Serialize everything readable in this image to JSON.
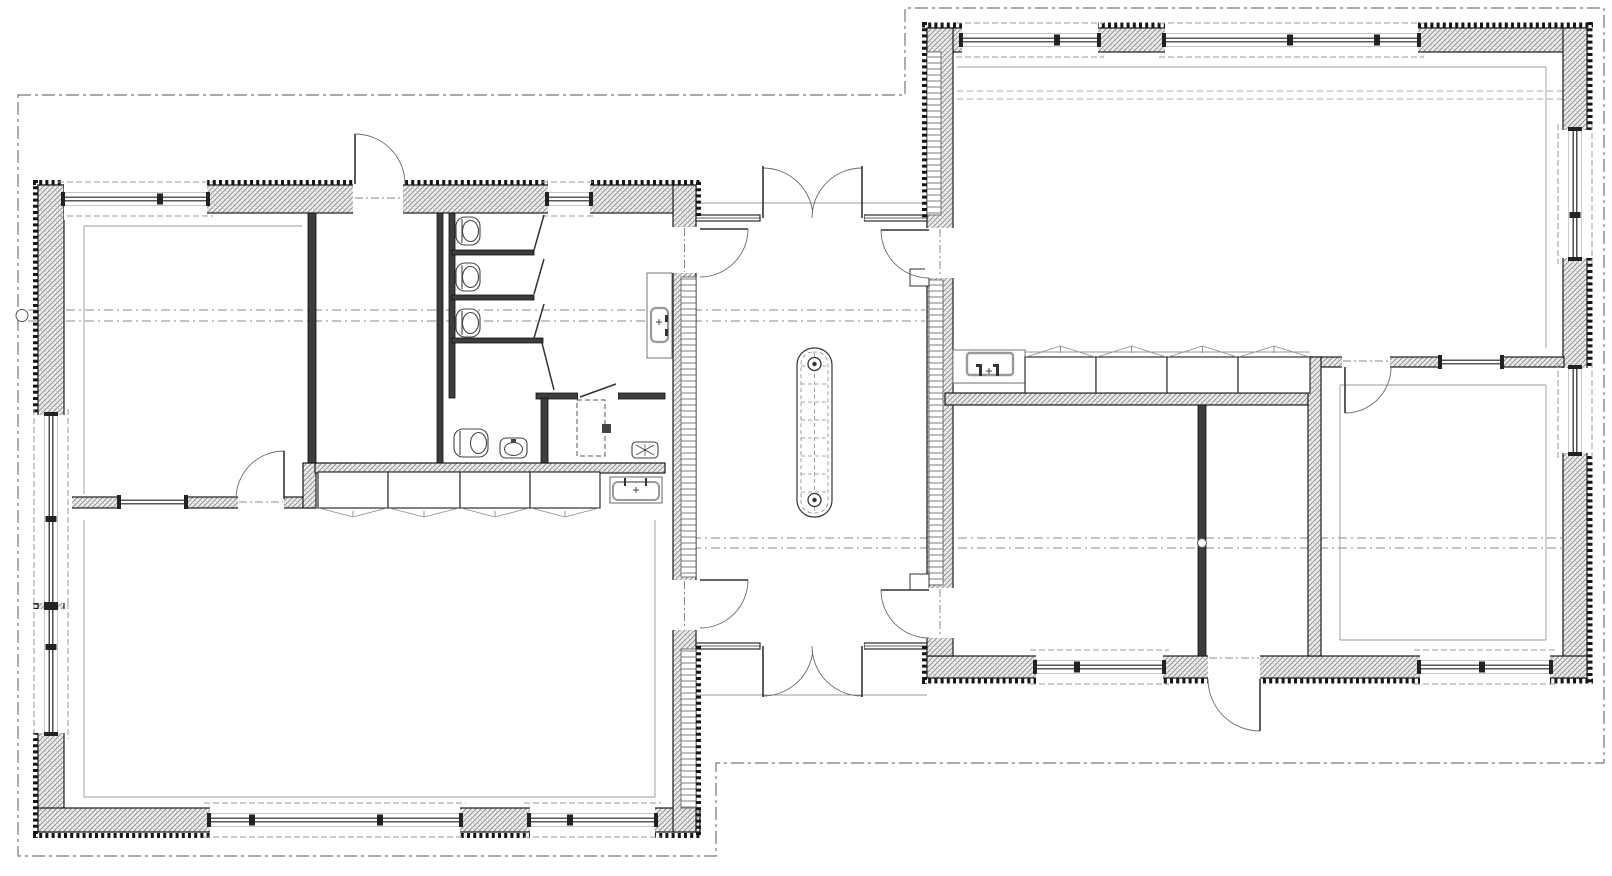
{
  "meta": {
    "canvas": {
      "w": 1612,
      "h": 876
    },
    "colors": {
      "paper": "#ffffff",
      "wall_line": "#1c1c1c",
      "wall_fill": "#f0f0ee",
      "partition_fill": "#3d3d3d",
      "teeth": "#161616",
      "arc": "#6a6a6a",
      "dash": "#8a8a8a",
      "thin": "#9a9a9a",
      "fixture": "#444444",
      "basin_stroke": "#999999"
    }
  },
  "plan": {
    "roof_overhang_outline": [
      [
        18,
        95
      ],
      [
        905,
        95
      ],
      [
        905,
        8
      ],
      [
        1604,
        8
      ],
      [
        1604,
        763
      ],
      [
        716,
        763
      ],
      [
        716,
        856
      ],
      [
        18,
        856
      ]
    ],
    "ridge_dash_lines": [
      [
        28,
        310,
        925,
        310
      ],
      [
        28,
        321,
        925,
        321
      ],
      [
        673,
        538,
        1563,
        538
      ],
      [
        673,
        548,
        1563,
        548
      ]
    ],
    "interior_dash_lines": [
      [
        957,
        91,
        1563,
        91
      ],
      [
        957,
        99,
        1563,
        99
      ]
    ],
    "marker_circles": [
      [
        22,
        315.5,
        6
      ],
      [
        1202,
        543,
        4.5
      ]
    ],
    "hatch_walls": [
      [
        38,
        185,
        658,
        28
      ],
      [
        38,
        185,
        26,
        647
      ],
      [
        38,
        808,
        662,
        24
      ],
      [
        673,
        185,
        23,
        647
      ],
      [
        927,
        28,
        660,
        24
      ],
      [
        1563,
        28,
        24,
        650
      ],
      [
        927,
        656,
        660,
        22
      ],
      [
        927,
        28,
        26,
        628
      ],
      [
        56,
        497,
        259,
        11
      ],
      [
        303,
        463,
        13,
        45
      ],
      [
        315,
        463,
        350,
        10
      ],
      [
        945,
        393,
        375,
        12
      ],
      [
        1308,
        357,
        256,
        10
      ],
      [
        1308,
        357,
        13,
        299
      ]
    ],
    "solid_walls": [
      [
        308,
        213,
        8,
        250
      ],
      [
        437,
        213,
        6,
        250
      ],
      [
        449,
        213,
        6,
        185
      ],
      [
        452,
        250,
        82,
        5
      ],
      [
        452,
        295,
        82,
        5
      ],
      [
        452,
        338,
        91,
        5
      ],
      [
        536,
        393,
        42,
        6
      ],
      [
        618,
        393,
        47,
        6
      ],
      [
        541,
        398,
        7,
        65
      ],
      [
        1198,
        405,
        8,
        251
      ]
    ],
    "ladder_strips": [
      [
        681,
        277,
        15,
        300
      ],
      [
        681,
        649,
        15,
        159
      ],
      [
        927,
        52,
        14,
        163
      ],
      [
        929,
        280,
        14,
        305
      ]
    ],
    "teeth_lines": [
      [
        33,
        182.5,
        701,
        182.5
      ],
      [
        35.5,
        180,
        35.5,
        838
      ],
      [
        33,
        835.5,
        701,
        835.5
      ],
      [
        698.5,
        182,
        698.5,
        218
      ],
      [
        698.5,
        646,
        698.5,
        835
      ],
      [
        924.5,
        22,
        924.5,
        218
      ],
      [
        924.5,
        646,
        924.5,
        684
      ],
      [
        922,
        25,
        1593,
        25
      ],
      [
        1590,
        22,
        1590,
        684
      ],
      [
        922,
        681,
        1593,
        681
      ]
    ],
    "glazed_walls": [
      [
        696,
        215,
        64,
        6
      ],
      [
        864,
        215,
        63,
        6
      ],
      [
        696,
        643,
        64,
        6
      ],
      [
        864,
        643,
        63,
        6
      ]
    ],
    "thin_lines": [
      [
        696,
        203,
        927,
        203
      ],
      [
        696,
        695,
        927,
        695
      ],
      [
        84,
        226,
        302,
        226
      ],
      [
        84,
        226,
        84,
        494
      ],
      [
        84,
        520,
        84,
        797
      ],
      [
        84,
        797,
        655,
        797
      ],
      [
        655,
        520,
        655,
        797
      ],
      [
        957,
        67,
        1546,
        67
      ],
      [
        1546,
        67,
        1546,
        348
      ],
      [
        1340,
        385,
        1546,
        385
      ],
      [
        1546,
        385,
        1546,
        640
      ],
      [
        1340,
        640,
        1546,
        640
      ],
      [
        1340,
        385,
        1340,
        640
      ],
      [
        1025,
        352,
        1310,
        352
      ],
      [
        953,
        379,
        1025,
        379
      ],
      [
        953,
        383,
        1025,
        383
      ]
    ],
    "windows": [
      {
        "o": "h",
        "a": 64,
        "b": 207,
        "c": 199,
        "m": [
          160
        ]
      },
      {
        "o": "h",
        "a": 548,
        "b": 590,
        "c": 199,
        "m": []
      },
      {
        "o": "v",
        "a": 415,
        "b": 603,
        "c": 51,
        "m": [
          519
        ]
      },
      {
        "o": "v",
        "a": 609,
        "b": 733,
        "c": 51,
        "m": [
          647
        ]
      },
      {
        "o": "h",
        "a": 210,
        "b": 460,
        "c": 820,
        "m": [
          252,
          380
        ]
      },
      {
        "o": "h",
        "a": 530,
        "b": 655,
        "c": 820,
        "m": [
          570
        ]
      },
      {
        "o": "h",
        "a": 962,
        "b": 1098,
        "c": 40,
        "m": [
          1057
        ]
      },
      {
        "o": "h",
        "a": 1165,
        "b": 1418,
        "c": 40,
        "m": [
          1290,
          1377
        ]
      },
      {
        "o": "v",
        "a": 130,
        "b": 258,
        "c": 1575,
        "m": [
          215
        ]
      },
      {
        "o": "v",
        "a": 368,
        "b": 453,
        "c": 1575,
        "m": []
      },
      {
        "o": "h",
        "a": 1036,
        "b": 1163,
        "c": 667,
        "m": [
          1077
        ]
      },
      {
        "o": "h",
        "a": 1420,
        "b": 1550,
        "c": 667,
        "m": [
          1482
        ]
      },
      {
        "o": "h",
        "a": 120,
        "b": 185,
        "c": 502,
        "m": [],
        "t": 9
      },
      {
        "o": "h",
        "a": 1441,
        "b": 1501,
        "c": 362,
        "m": [],
        "t": 9
      }
    ],
    "doors": [
      {
        "clear": [
          353,
          177,
          50,
          40
        ],
        "leaf": [
          355,
          184,
          355,
          134
        ],
        "arc": {
          "r": 50,
          "s": [
            355,
            134
          ],
          "e": [
            405,
            184
          ],
          "sw": 1
        },
        "dash": [
          355,
          198,
          403,
          198
        ]
      },
      {
        "clear": [
          670,
          227,
          34,
          46
        ],
        "leaf": [
          700,
          229,
          748,
          229
        ],
        "arc": {
          "r": 48,
          "s": [
            748,
            229
          ],
          "e": [
            700,
            277
          ],
          "sw": 1
        },
        "dash": [
          684.5,
          228,
          684.5,
          272
        ]
      },
      {
        "clear": [
          670,
          580,
          34,
          50
        ],
        "leaf": [
          700,
          580,
          748,
          580
        ],
        "arc": {
          "r": 48,
          "s": [
            748,
            580
          ],
          "e": [
            700,
            628
          ],
          "sw": 1
        },
        "dash": [
          684.5,
          581,
          684.5,
          627
        ]
      },
      {
        "clear": [
          925,
          228,
          30,
          50
        ],
        "leaf": [
          929,
          230,
          881,
          230
        ],
        "arc": {
          "r": 48,
          "s": [
            881,
            230
          ],
          "e": [
            929,
            278
          ],
          "sw": 0
        },
        "dash": [
          940,
          229,
          940,
          277
        ]
      },
      {
        "clear": [
          925,
          588,
          30,
          50
        ],
        "leaf": [
          929,
          590,
          881,
          590
        ],
        "arc": {
          "r": 48,
          "s": [
            881,
            590
          ],
          "e": [
            929,
            638
          ],
          "sw": 0
        },
        "dash": [
          940,
          589,
          940,
          637
        ]
      },
      {
        "clear": [
          761,
          213,
          51,
          10
        ],
        "leaf": [
          763,
          218,
          763,
          166
        ],
        "arc": {
          "r": 50,
          "s": [
            763,
            168
          ],
          "e": [
            813,
            218
          ],
          "sw": 1
        }
      },
      {
        "clear": [
          812,
          213,
          52,
          10
        ],
        "leaf": [
          862,
          218,
          862,
          166
        ],
        "arc": {
          "r": 50,
          "s": [
            862,
            168
          ],
          "e": [
            812,
            218
          ],
          "sw": 0
        }
      },
      {
        "clear": [
          761,
          641,
          51,
          10
        ],
        "leaf": [
          763,
          646,
          763,
          697
        ],
        "arc": {
          "r": 50,
          "s": [
            763,
            696
          ],
          "e": [
            813,
            646
          ],
          "sw": 0
        }
      },
      {
        "clear": [
          812,
          641,
          52,
          10
        ],
        "leaf": [
          862,
          646,
          862,
          697
        ],
        "arc": {
          "r": 50,
          "s": [
            862,
            696
          ],
          "e": [
            812,
            646
          ],
          "sw": 1
        }
      },
      {
        "clear": [
          238,
          494,
          46,
          16
        ],
        "leaf": [
          284,
          499,
          284,
          451
        ],
        "arc": {
          "r": 48,
          "s": [
            284,
            451
          ],
          "e": [
            236,
            499
          ],
          "sw": 0
        },
        "dash": [
          239,
          502,
          283,
          502
        ]
      },
      {
        "clear": [
          578,
          391,
          40,
          9
        ],
        "leaf": [
          580,
          397,
          616,
          384
        ]
      },
      {
        "clear": [
          1342,
          354,
          48,
          15
        ],
        "leaf": [
          1345,
          367,
          1345,
          413
        ],
        "arc": {
          "r": 46,
          "s": [
            1391,
            367
          ],
          "e": [
            1345,
            413
          ],
          "sw": 1
        },
        "dash": [
          1343,
          361,
          1389,
          361
        ]
      },
      {
        "clear": [
          1208,
          652,
          52,
          33
        ],
        "leaf": [
          1260,
          679,
          1260,
          731
        ],
        "arc": {
          "r": 52,
          "s": [
            1208,
            679
          ],
          "e": [
            1260,
            731
          ],
          "sw": 0
        },
        "dash": [
          1209,
          658,
          1259,
          658
        ]
      }
    ],
    "stall_door_lines": [
      [
        544,
        215,
        534,
        250
      ],
      [
        544,
        259,
        534,
        294
      ],
      [
        544,
        304,
        534,
        338
      ],
      [
        542,
        343,
        554,
        390
      ]
    ],
    "jamb_steps": [
      [
        910,
        269,
        19,
        17
      ],
      [
        910,
        574,
        19,
        16
      ]
    ],
    "mat": {
      "x": 797,
      "y": 348,
      "w": 35,
      "h": 169,
      "r": 17,
      "grid_step": 18,
      "drains": [
        [
          814.5,
          364
        ],
        [
          814.5,
          500
        ]
      ]
    },
    "fixtures": {
      "wc_toilets": [
        [
          456,
          217
        ],
        [
          456,
          263
        ],
        [
          456,
          309
        ]
      ],
      "bath_toilet": [
        454,
        429
      ],
      "bath_bidet": [
        500,
        438
      ],
      "shower_dashed": [
        577,
        400,
        28,
        56
      ],
      "shower_head": [
        602,
        424,
        9,
        9
      ],
      "shower_tray": [
        632,
        442,
        26,
        16
      ],
      "vanity": [
        610,
        477,
        52,
        26
      ],
      "corridor_basin": {
        "counter": [
          647,
          273,
          25,
          85
        ],
        "basin": [
          651,
          308,
          17,
          34
        ],
        "taps": [
          [
            665,
            315
          ],
          [
            665,
            329
          ]
        ]
      },
      "kitchen_sink": {
        "counter": [
          953,
          350,
          72,
          33
        ],
        "basin": [
          967,
          353,
          46,
          22
        ],
        "taps": [
          [
            979,
            364
          ],
          [
            996,
            364
          ]
        ]
      },
      "kitchen_cabinets": [
        [
          1025,
          357,
          71,
          36
        ],
        [
          1096,
          357,
          71,
          36
        ],
        [
          1167,
          357,
          71,
          36
        ],
        [
          1238,
          357,
          72,
          36
        ]
      ],
      "wardrobes": [
        [
          318,
          472,
          70,
          36
        ],
        [
          388,
          472,
          72,
          36
        ],
        [
          460,
          472,
          70,
          36
        ],
        [
          530,
          472,
          70,
          36
        ]
      ]
    }
  }
}
